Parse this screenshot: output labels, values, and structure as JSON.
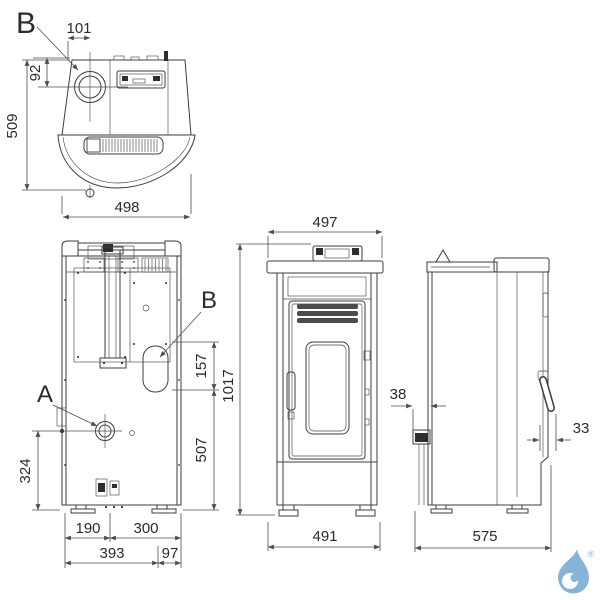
{
  "callouts": {
    "top_b": "B",
    "rear_a": "A",
    "rear_b": "B"
  },
  "dims": {
    "top": {
      "flue_offset_x": "101",
      "flue_offset_y": "92",
      "depth": "509",
      "width": "498"
    },
    "rear": {
      "flue_span": "157",
      "flue_to_base": "507",
      "intake_height": "324",
      "base_left": "190",
      "base_right": "300",
      "base_main": "393",
      "base_side": "97"
    },
    "front": {
      "top_width": "497",
      "height": "1017",
      "base_width": "491"
    },
    "side": {
      "rear_pipe_offset": "38",
      "handle_offset": "33",
      "depth": "575"
    }
  },
  "logo": {
    "registered": "®",
    "color": "#86b4d8"
  }
}
